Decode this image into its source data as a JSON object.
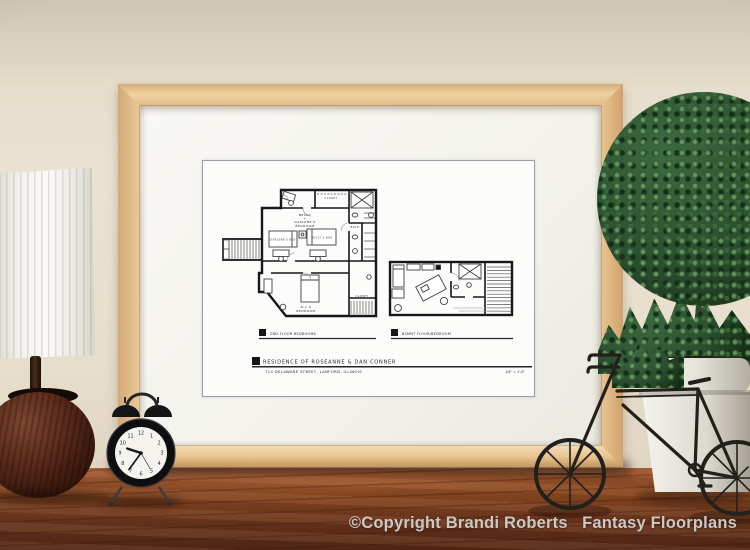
{
  "watermark": {
    "text": "©Copyright Brandi Roberts   Fantasy Floorplans"
  },
  "print": {
    "captions": {
      "left_plan": "2ND FLOOR BEDROOMS",
      "right_plan": "BSMNT FLOOR/BEDROOM"
    },
    "title_block": {
      "line1": "RESIDENCE OF ROSEANNE & DAN CONNER",
      "line2": "714 DELAWARE STREET, LANFORD, ILLINOIS",
      "scale_note": "1/4\" = 1'-0\""
    },
    "second_floor_labels": {
      "bedroom_line1": "BECKY",
      "bedroom_line2": "+",
      "bedroom_line3": "DARLENE'S",
      "bedroom_line4": "BEDROOM",
      "bed_left": "DARLENE'S BED",
      "bed_right": "BECKY'S BED",
      "dj_line1": "D.J.'S",
      "dj_line2": "BEDROOM",
      "closet_top": "CLOSET",
      "closet_bottom": "CLOSET",
      "bath": "BATH"
    }
  },
  "objects": {
    "clock": {
      "time": "9:36",
      "numerals": [
        "12",
        "1",
        "2",
        "3",
        "4",
        "5",
        "6",
        "7",
        "8",
        "9",
        "10",
        "11"
      ]
    }
  },
  "colors": {
    "wall": "#e8e0ce",
    "table_wood": "#7a3f24",
    "frame_wood": "#ecca97",
    "mat": "#f6f5f0",
    "plan_ink": "#1c1c22",
    "foliage": "#2d4e30",
    "pot": "#eeece4",
    "bike_metal": "#23201b",
    "watermark_text": "#cbc8c4"
  }
}
